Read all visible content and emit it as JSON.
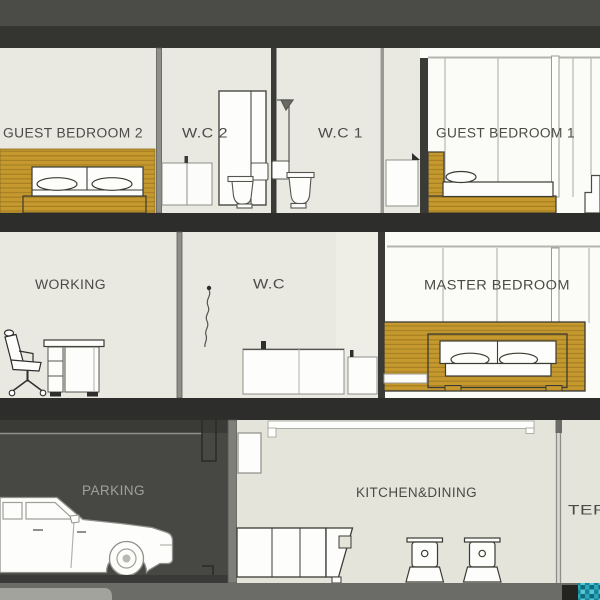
{
  "scene": {
    "type": "building-section-drawing",
    "floors": 3
  },
  "palette": {
    "roof_band": "#4b4b48",
    "roof_slab": "#343431",
    "floor_slab": "#2d2d2b",
    "wall_beige": "#e9e9e1",
    "glazing_white": "#fbfbf8",
    "wood": "#c6992f",
    "wood_stripe": "#a57f22",
    "garage_dark": "#474744",
    "garage_column": "#7e7e7a",
    "kitchen_beige": "#e4e4db",
    "ground_slab": "#6b6b68",
    "label_dark": "#4b4b45",
    "label_light": "#a0a09b",
    "pool_teal": "#2aa6b8"
  },
  "floors": {
    "top": {
      "name": "second-floor",
      "rooms": [
        {
          "id": "guest-bedroom-2",
          "label": "GUEST BEDROOM 2",
          "furniture": [
            "double-bed",
            "wood-headboard-wall"
          ]
        },
        {
          "id": "wc-2",
          "label": "W.C 2",
          "furniture": [
            "low-cabinet",
            "tall-wardrobe",
            "toilet"
          ]
        },
        {
          "id": "wc-1",
          "label": "W.C 1",
          "furniture": [
            "shower",
            "toilet",
            "vanity-cabinet"
          ]
        },
        {
          "id": "guest-bedroom-1",
          "label": "GUEST BEDROOM 1",
          "furniture": [
            "platform-bed",
            "bedside-steps"
          ]
        }
      ]
    },
    "middle": {
      "name": "first-floor",
      "rooms": [
        {
          "id": "working",
          "label": "WORKING",
          "furniture": [
            "office-chair",
            "desk"
          ]
        },
        {
          "id": "wc",
          "label": "W.C",
          "furniture": [
            "shower-hose",
            "counter-cabinet"
          ]
        },
        {
          "id": "master-bedroom",
          "label": "MASTER BEDROOM",
          "furniture": [
            "platform-double-bed"
          ]
        }
      ]
    },
    "ground": {
      "name": "ground-floor",
      "rooms": [
        {
          "id": "parking",
          "label": "PARKING",
          "furniture": [
            "car"
          ]
        },
        {
          "id": "kitchen-dining",
          "label": "KITCHEN&DINING",
          "furniture": [
            "base-cabinets",
            "dining-chairs",
            "service-window"
          ]
        },
        {
          "id": "terrace",
          "label": "TERRACE",
          "furniture": [
            "pool-edge-tiles"
          ]
        }
      ]
    }
  }
}
